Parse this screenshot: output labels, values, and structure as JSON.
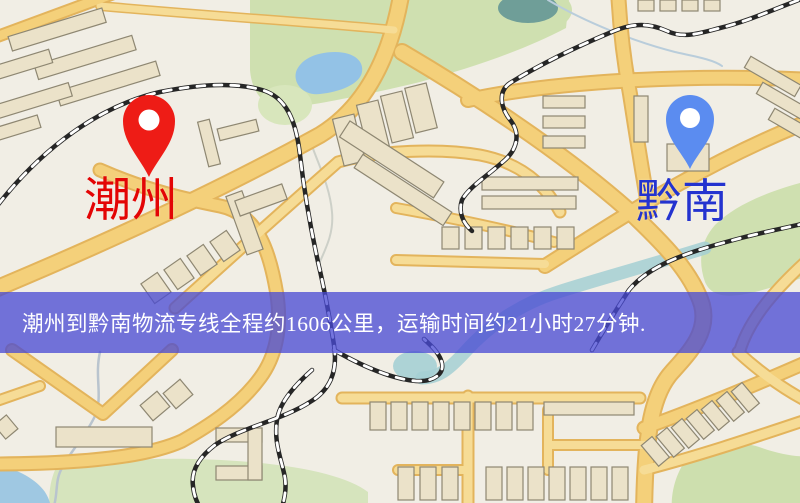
{
  "map": {
    "description": "road map with logistics route banner",
    "origin_marker": {
      "label": "潮州",
      "label_color": "#e30505",
      "pin_color": "#ee1c16",
      "pin_icon": "location-pin-icon"
    },
    "destination_marker": {
      "label": "黔南",
      "label_color": "#2433cf",
      "pin_color": "#5b8cf0",
      "pin_icon": "location-pin-icon"
    },
    "banner": {
      "text": "潮州到黔南物流专线全程约1606公里，运输时间约21小时27分钟.",
      "background_rgba": "rgba(72,74,212,0.76)",
      "text_color": "#ffffff"
    },
    "route": {
      "origin": "潮州",
      "destination": "黔南",
      "distance_km": "1606",
      "duration": "21小时27分钟"
    },
    "palette": {
      "background": "#f1eee5",
      "road_fill": "#f4d07a",
      "road_border": "#e3b45c",
      "minor_road": "#f6dc96",
      "building_fill": "#ebe2c9",
      "building_outline": "#8e8772",
      "green_area": "#cfe0b0",
      "water": "#93c2e6",
      "river": "#a5cfd4",
      "railway": "#262626"
    }
  }
}
